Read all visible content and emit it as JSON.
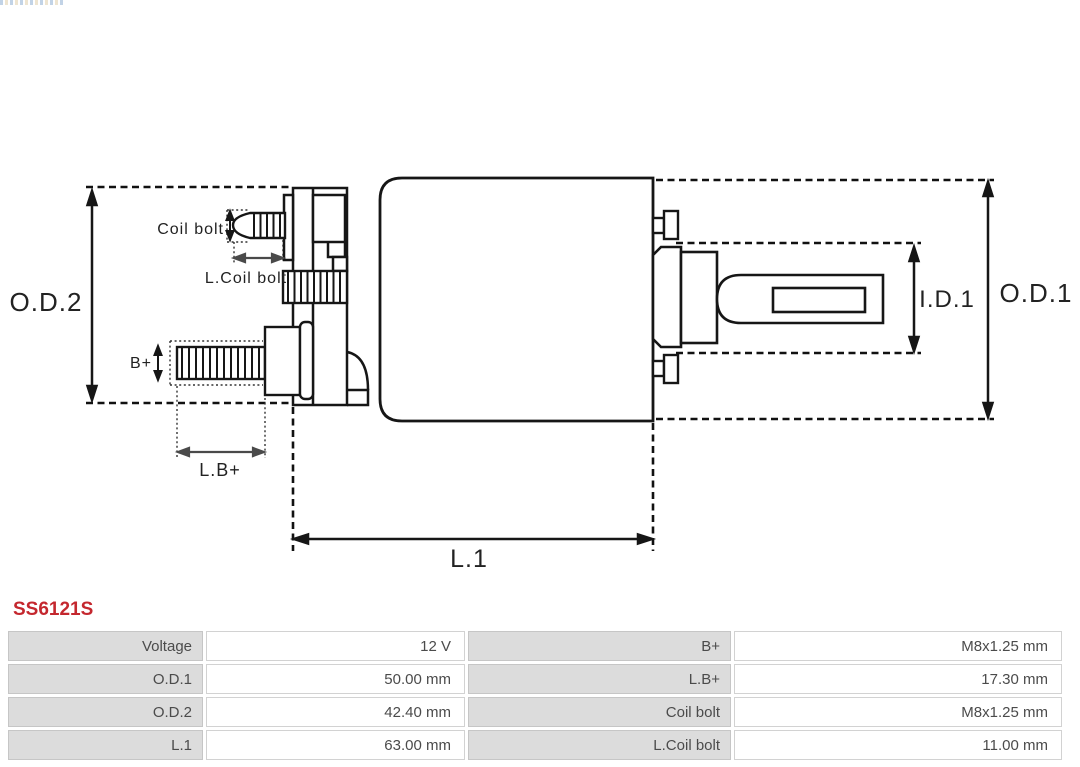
{
  "part": {
    "number": "SS6121S",
    "accent_color": "#c4272e"
  },
  "icons": {
    "brand_strip": "brand-logo-strip",
    "watermark": "faint-center-watermark"
  },
  "diagram": {
    "type": "starter-solenoid-dimension-drawing",
    "labels": {
      "od2": "O.D.2",
      "od1": "O.D.1",
      "id1": "I.D.1",
      "l1": "L.1",
      "lb_plus": "L.B+",
      "b_plus": "B+",
      "coil_bolt": "Coil bolt",
      "l_coil_bolt": "L.Coil bolt"
    }
  },
  "table": {
    "rows": [
      {
        "label1": "Voltage",
        "value1": "12 V",
        "label2": "B+",
        "value2": "M8x1.25 mm"
      },
      {
        "label1": "O.D.1",
        "value1": "50.00 mm",
        "label2": "L.B+",
        "value2": "17.30 mm"
      },
      {
        "label1": "O.D.2",
        "value1": "42.40 mm",
        "label2": "Coil bolt",
        "value2": "M8x1.25 mm"
      },
      {
        "label1": "L.1",
        "value1": "63.00 mm",
        "label2": "L.Coil bolt",
        "value2": "11.00 mm"
      }
    ]
  },
  "colors": {
    "line": "#161616",
    "dim_gray": "#4a4a4a",
    "label_cell_bg": "#dcdcdc",
    "table_text": "#4b4b4b"
  }
}
